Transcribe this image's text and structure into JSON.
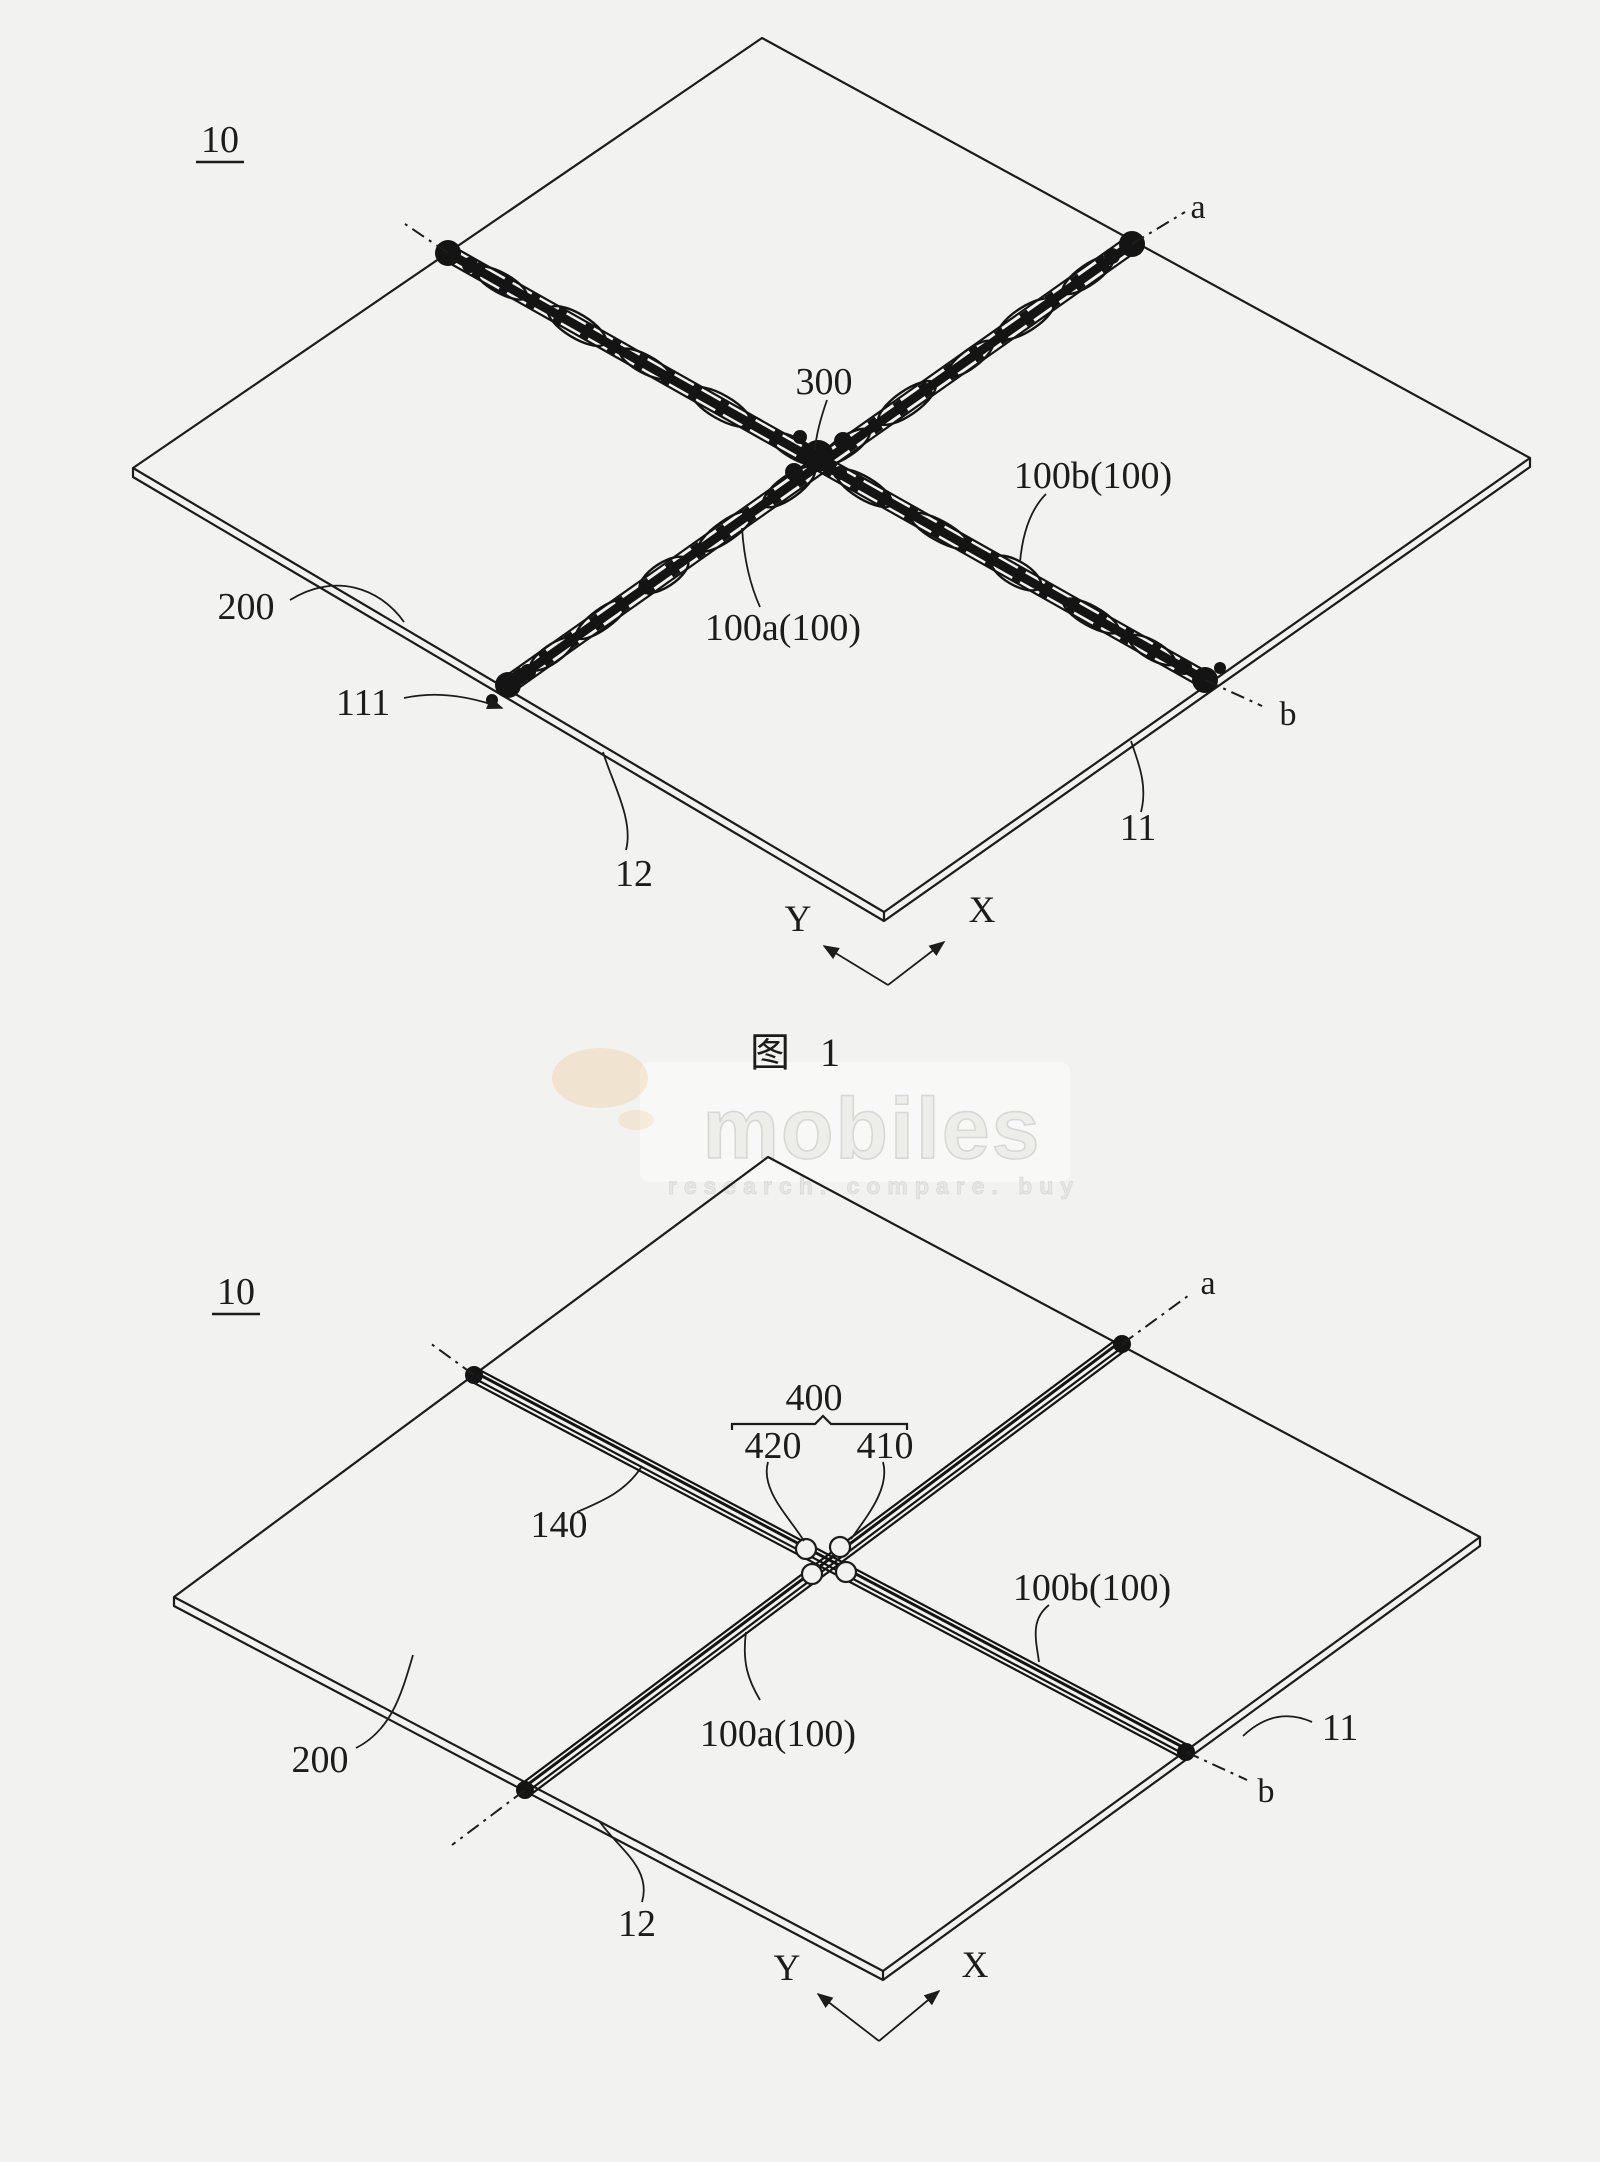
{
  "page": {
    "caption": "图 1",
    "ink_color": "#1c1c1c",
    "background_color": "#f2f2f0"
  },
  "watermark": {
    "brand": "mobiles",
    "tagline": "research. compare. buy",
    "gray": "#ededea",
    "accent_orange": "#e8a13c"
  },
  "figure1": {
    "labels": {
      "assembly": "10",
      "section_a": "a",
      "section_b": "b",
      "r300": "300",
      "r100b": "100b(100)",
      "r100a": "100a(100)",
      "r200": "200",
      "r111": "111",
      "r12": "12",
      "r11": "11",
      "axis_y": "Y",
      "axis_x": "X"
    }
  },
  "figure2": {
    "labels": {
      "assembly": "10",
      "section_a": "a",
      "section_b": "b",
      "r400": "400",
      "r420": "420",
      "r410": "410",
      "r140": "140",
      "r100b": "100b(100)",
      "r100a": "100a(100)",
      "r200": "200",
      "r12": "12",
      "r11": "11",
      "axis_y": "Y",
      "axis_x": "X"
    }
  }
}
